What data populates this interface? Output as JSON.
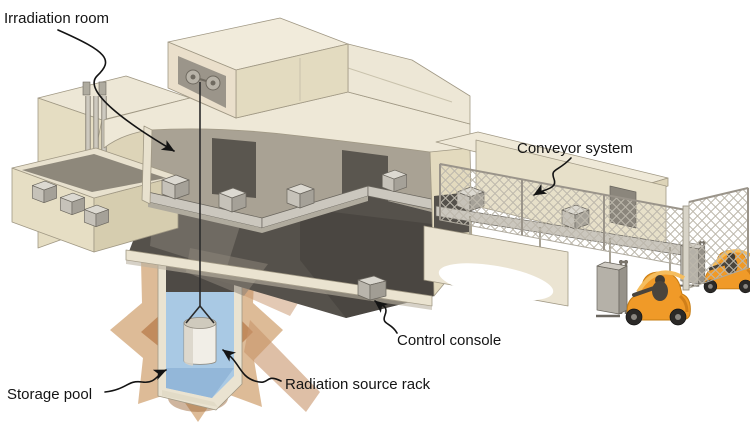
{
  "figure": {
    "type": "cutaway-illustration",
    "labels": {
      "irradiation_room": "Irradiation room",
      "conveyor_system": "Conveyor system",
      "control_console": "Control console",
      "storage_pool": "Storage pool",
      "radiation_source_rack": "Radiation source rack"
    },
    "colors": {
      "background": "#FFFFFF",
      "building_wall": "#E4DCC1",
      "roof": "#EEE8D7",
      "interior_wall": "#A9A294",
      "interior_floor": "#55514B",
      "conveyor": "#CBC7BE",
      "pool_water": "#A9C9E4",
      "earth": "#C08A5A",
      "forklift_orange": "#F09A28",
      "label_text": "#141414"
    }
  }
}
